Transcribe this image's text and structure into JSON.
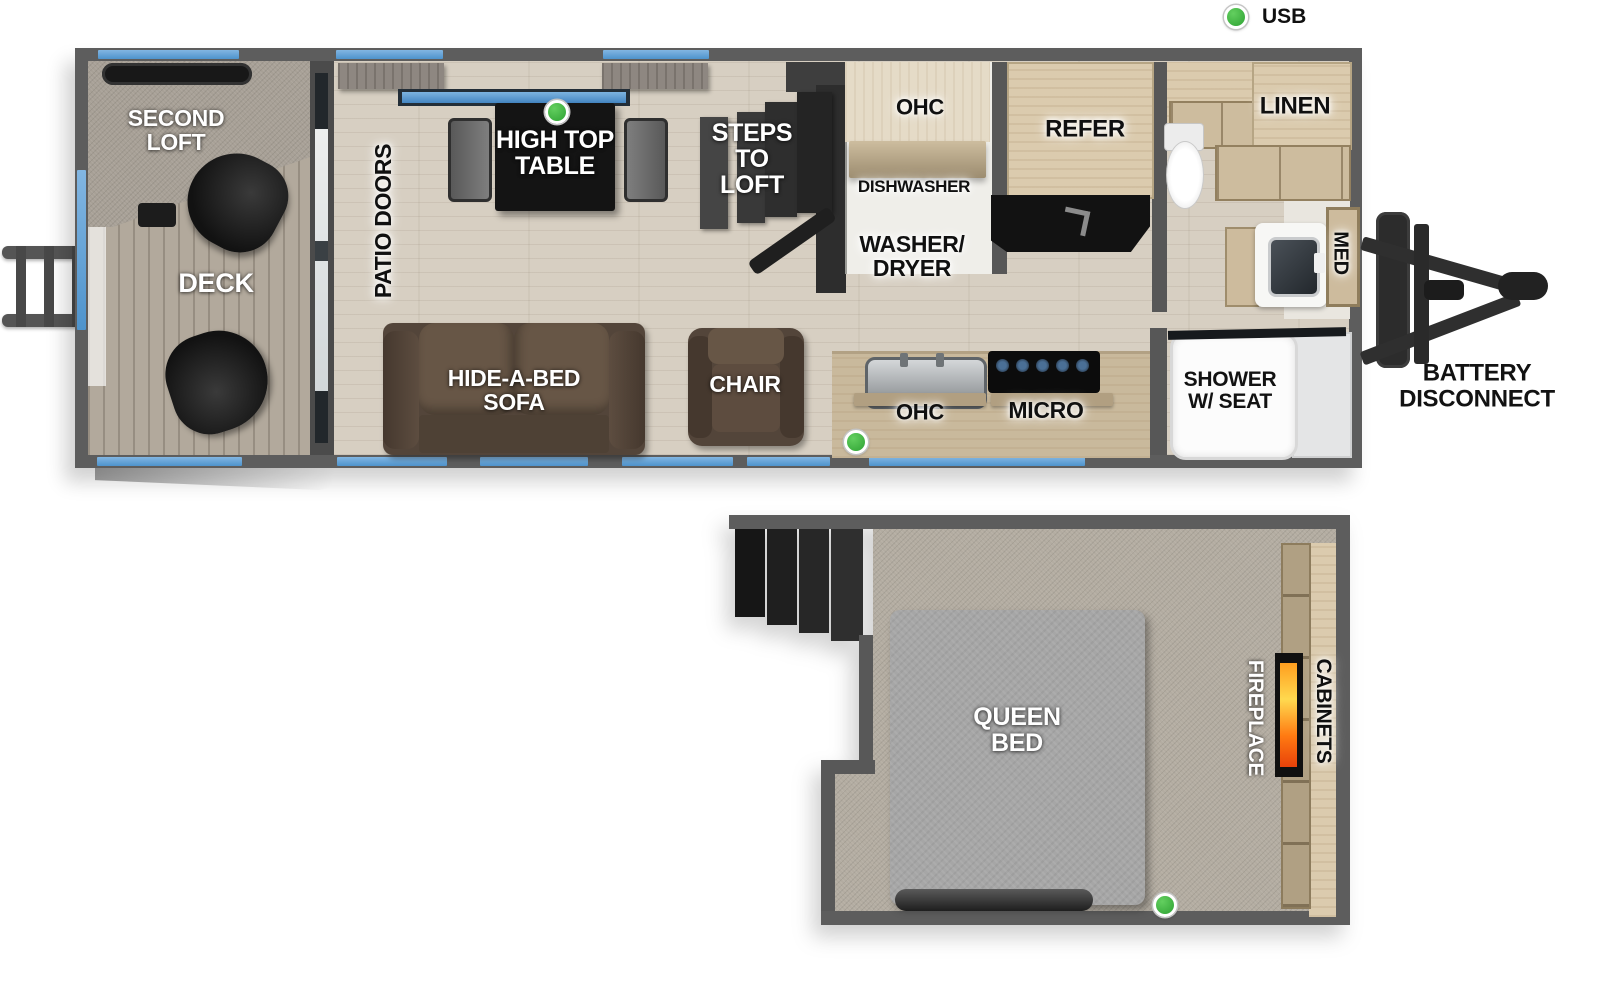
{
  "legend": {
    "usb": "USB"
  },
  "colors": {
    "accent_blue": "#5b9ed7",
    "usb_green": "#3cb43e",
    "wall_gray": "#5d5d5d",
    "flame_orange": "#ff7a12"
  },
  "main_floor": {
    "labels": {
      "second_loft": "SECOND\nLOFT",
      "deck": "DECK",
      "patio_doors": "PATIO DOORS",
      "high_top_table": "HIGH TOP\nTABLE",
      "steps_to_loft": "STEPS\nTO\nLOFT",
      "ohc_upper": "OHC",
      "dishwasher": "DISHWASHER",
      "washer_dryer": "WASHER/\nDRYER",
      "refer": "REFER",
      "linen": "LINEN",
      "med": "MED",
      "hide_a_bed_sofa": "HIDE-A-BED\nSOFA",
      "chair": "CHAIR",
      "ohc_lower": "OHC",
      "micro": "MICRO",
      "shower": "SHOWER\nW/ SEAT",
      "battery_disconnect": "BATTERY\nDISCONNECT"
    }
  },
  "loft_floor": {
    "labels": {
      "queen_bed": "QUEEN\nBED",
      "fireplace": "FIREPLACE",
      "cabinets": "CABINETS"
    }
  }
}
